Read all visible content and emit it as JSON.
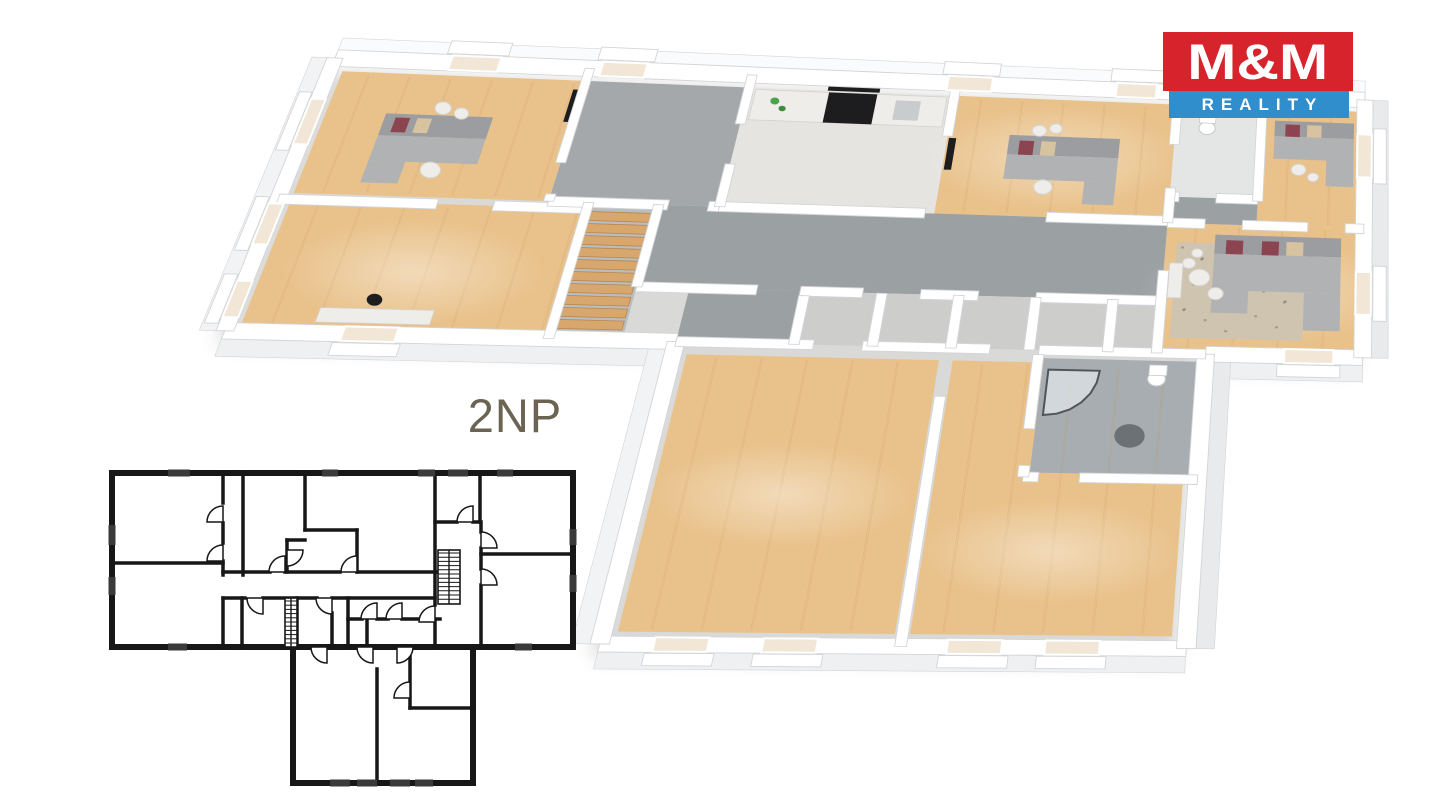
{
  "page": {
    "width": 1440,
    "height": 810,
    "background": "#ffffff"
  },
  "floor_label": "2NP",
  "logo": {
    "top_text": "M&M",
    "bottom_text": "REALITY",
    "red": "#d7232b",
    "blue": "#2f8ecb",
    "text_color": "#ffffff"
  },
  "palette": {
    "wall": "#ffffff",
    "wall_edge": "#d2d5d8",
    "face_top": "#fafbfc",
    "face_left": "#f2f3f5",
    "face_right": "#e8eaec",
    "face_south": "#eef0f2",
    "wood": "#e9c28b",
    "wood_light": "#f1d4a5",
    "wood_seam": "#c89a62",
    "gray_corridor": "#9ba0a3",
    "gray_room": "#a4a8ab",
    "light_room": "#cdcecc",
    "kitchen": "#e6e4e0",
    "bath_tile": "#e4e6e6",
    "annex_bath": "#a7adb0",
    "sofa": "#b0b2b4",
    "sofa_dark": "#9b9da0",
    "pillow_red": "#8d4451",
    "pillow_beige": "#d8c3a0",
    "rug": "#cec4b0",
    "rug_dark": "#6b7174",
    "stairs": "#d7a76d",
    "stairs_edge": "#b9854d",
    "appliance": "#1d1d1f",
    "table": "#efede9",
    "table_edge": "#d5d3cf",
    "sink": "#c9ccce",
    "plant_green": "#4aa34a",
    "window_glass": "#f2e7d6",
    "window_frame": "#ffffff",
    "shadow": "#55544e",
    "glass": "#dfe6e9",
    "glass_frame": "#34383c",
    "plan_line": "#171717",
    "plan_window": "#3a3a3a"
  }
}
